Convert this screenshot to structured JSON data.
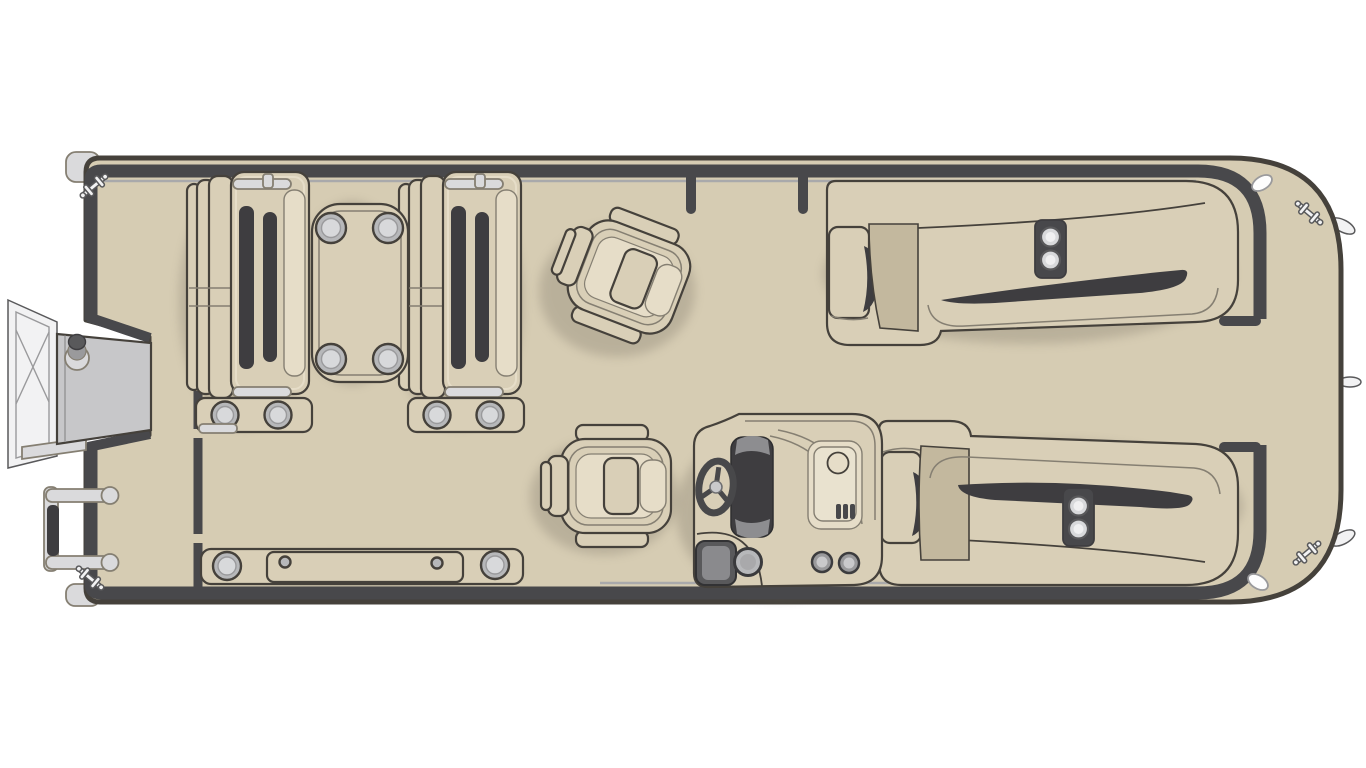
{
  "meta": {
    "title": "Pontoon boat floor plan — top-down deck layout diagram",
    "view": "top-down",
    "type": "boat-floor-plan-illustration"
  },
  "colors": {
    "background": "#ffffff",
    "deck": "#d6ccb3",
    "seat": "#d9cfb7",
    "seat_light": "#e6ddc8",
    "seat_deep": "#c3b89e",
    "dark": "#3e3d40",
    "outline": "#45413b",
    "outline_soft": "#857f72",
    "fence": "#48484b",
    "fence_light": "#a9a9ab",
    "metal_white": "#f2f2f3",
    "metal_light": "#dadadc",
    "metal_mid": "#9a9a9c",
    "metal_dark": "#59595b",
    "door_gray": "#c7c7c9",
    "ring_fill": "#b7b8ba",
    "ring_inner": "#d8d9db",
    "wheel": "#48484a",
    "shadow_c": "#6b6356"
  },
  "labels": {
    "diagram": "Pontoon boat floor plan — top-down deck layout diagram",
    "hull": "pontoon hull and deck",
    "fence": "perimeter fence rail",
    "bow_gate_posts": "top side gate posts",
    "stern_gate": "rear gate opening with rail ends",
    "bow_door": "side boarding door (open)",
    "door_frame": "boarding door frame",
    "ladder": "boarding ladder",
    "cleats": "mooring cleats",
    "nav_lights": "deck lights",
    "trailer_tabs": "hull side fittings",
    "bow_seat_left": "forward lounge seat with cupholder base",
    "bow_seat_right": "forward lounge seat with cupholder base",
    "table": "pedestal table with four cupholders",
    "captain_chair_upper": "swivel captain chair (rotated)",
    "captain_chair_lower": "swivel captain chair at helm",
    "helm_console": "helm console with steering wheel, sink and storage",
    "steering_wheel": "steering wheel",
    "sink": "sink unit with faucet and vent",
    "bin": "waste bin",
    "cupholders": "cupholders",
    "floor_hatch": "in-floor storage hatch with cupholders",
    "lounge_top": "aft L-shaped lounge with chaise and armrest cupholders",
    "lounge_bottom": "aft L-shaped lounge with chaise and armrest cupholders",
    "rear_platform": "open rear deck platform"
  },
  "components": [
    {
      "id": "hull",
      "count": 1
    },
    {
      "id": "boarding-door",
      "count": 1
    },
    {
      "id": "boarding-ladder",
      "count": 1
    },
    {
      "id": "forward-lounge-seat",
      "count": 2
    },
    {
      "id": "pedestal-table",
      "count": 1
    },
    {
      "id": "captain-chair",
      "count": 2
    },
    {
      "id": "helm-console",
      "count": 1
    },
    {
      "id": "l-shaped-lounge",
      "count": 2
    },
    {
      "id": "armrest-cupholder-console",
      "count": 3
    },
    {
      "id": "in-floor-storage-hatch",
      "count": 1
    },
    {
      "id": "mooring-cleat",
      "count": 4
    },
    {
      "id": "gate-post",
      "count": 2
    },
    {
      "id": "gate-rail-end",
      "count": 2
    }
  ]
}
